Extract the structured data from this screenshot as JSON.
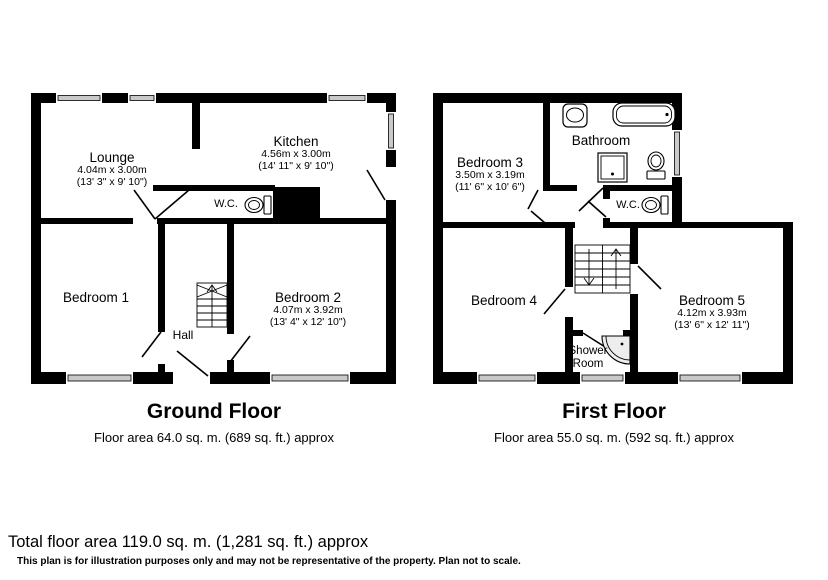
{
  "palette": {
    "wall": "#000000",
    "background": "#ffffff",
    "window_fill": "#c9c9c9",
    "fixture_fill": "#ededed"
  },
  "ground_floor": {
    "title": "Ground Floor",
    "area_line": "Floor area 64.0 sq. m. (689 sq. ft.) approx",
    "rooms": {
      "lounge": {
        "name": "Lounge",
        "metric": "4.04m x 3.00m",
        "imperial": "(13' 3\" x 9' 10\")"
      },
      "kitchen": {
        "name": "Kitchen",
        "metric": "4.56m x 3.00m",
        "imperial": "(14' 11\" x 9' 10\")"
      },
      "wc": {
        "name": "W.C."
      },
      "bedroom1": {
        "name": "Bedroom 1"
      },
      "bedroom2": {
        "name": "Bedroom 2",
        "metric": "4.07m x 3.92m",
        "imperial": "(13' 4\" x 12' 10\")"
      },
      "hall": {
        "name": "Hall"
      }
    }
  },
  "first_floor": {
    "title": "First Floor",
    "area_line": "Floor area 55.0 sq. m. (592 sq. ft.) approx",
    "rooms": {
      "bedroom3": {
        "name": "Bedroom 3",
        "metric": "3.50m x 3.19m",
        "imperial": "(11' 6\" x 10' 6\")"
      },
      "bathroom": {
        "name": "Bathroom"
      },
      "wc": {
        "name": "W.C."
      },
      "bedroom4": {
        "name": "Bedroom 4"
      },
      "bedroom5": {
        "name": "Bedroom 5",
        "metric": "4.12m x 3.93m",
        "imperial": "(13' 6\" x 12' 11\")"
      },
      "shower_room": {
        "name": "Shower Room"
      }
    }
  },
  "footer": {
    "total_line": "Total floor area 119.0 sq. m. (1,281 sq. ft.) approx",
    "disclaimer": "This plan is for illustration purposes only and may not be representative of the property. Plan not to scale."
  }
}
